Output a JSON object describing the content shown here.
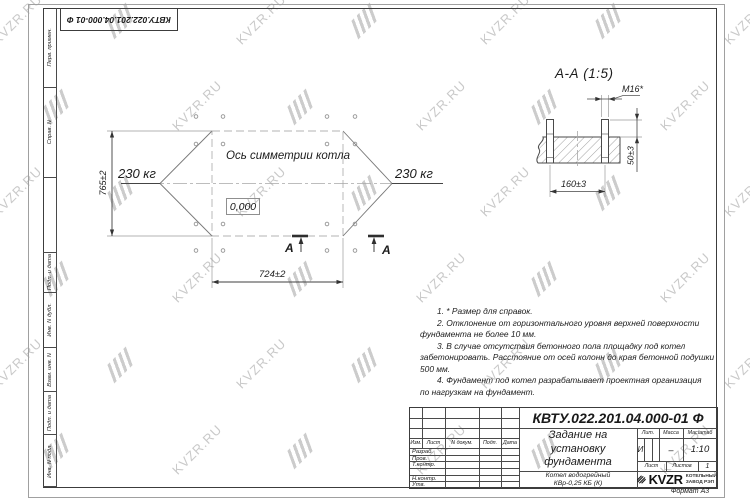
{
  "watermark": {
    "text": "KVZR.RU"
  },
  "stamp": {
    "doc_number": "КВТУ.022.201.04.000-01 Ф"
  },
  "margin": {
    "cells": [
      "Перв. примен.",
      "Справ. N",
      "",
      "Подп. и дата",
      "Инв. N дубл.",
      "Взам. инв. N",
      "Подп. и дата",
      "Инв. N подл."
    ]
  },
  "plan": {
    "axis_label": "Ось симметрии котла",
    "load_left": "230 кг",
    "load_right": "230 кг",
    "level_mark": "0,000",
    "dim_height": "765±2",
    "dim_width": "724±2",
    "section_letter_left": "А",
    "section_letter_right": "А"
  },
  "section": {
    "title": "А-А (1:5)",
    "thread_label": "M16*",
    "dim_protrusion": "50±3",
    "dim_spacing": "160±3"
  },
  "notes": {
    "lines": [
      {
        "text": "1. * Размер для справок."
      },
      {
        "text": "2. Отклонение от горизонтального уровня верхней поверхности"
      },
      {
        "text": "фундамента не более 10 мм."
      },
      {
        "text": "3. В случае отсутствия бетонного пола площадку под котел"
      },
      {
        "text": "забетонировать. Расстояние от осей колонн до края бетонной подушки"
      },
      {
        "text": "500 мм."
      },
      {
        "text": "4. Фундамент под котел разрабатывает проектная организация"
      },
      {
        "text": "по нагрузкам на фундамент."
      }
    ]
  },
  "titleblock": {
    "doc_number": "КВТУ.022.201.04.000-01 Ф",
    "title_line1": "Задание на",
    "title_line2": "установку",
    "title_line3": "фундамента",
    "product_line1": "Котел водогрейный",
    "product_line2": "КВр-0,25 КБ (К)",
    "col_izm": "Изм.",
    "col_list": "Лист",
    "col_doc": "N докум.",
    "col_podp": "Подп.",
    "col_data": "Дата",
    "row_razrab": "Разраб.",
    "row_prov": "Пров.",
    "row_tkontr": "Т.контр.",
    "row_nkontr": "Н.контр.",
    "row_utv": "Утв.",
    "lit_label": "Лит.",
    "mass_label": "Масса",
    "scale_label": "Масштаб",
    "lit_value": "И",
    "mass_value": "–",
    "scale_value": "1:10",
    "sheet_label": "Лист",
    "sheets_label": "Листов",
    "sheets_value": "1",
    "brand": "KVZR",
    "brand_line1": "КОТЕЛЬНЫЙ",
    "brand_line2": "ЗАВОД РЭП",
    "format_label": "Формат А3"
  }
}
